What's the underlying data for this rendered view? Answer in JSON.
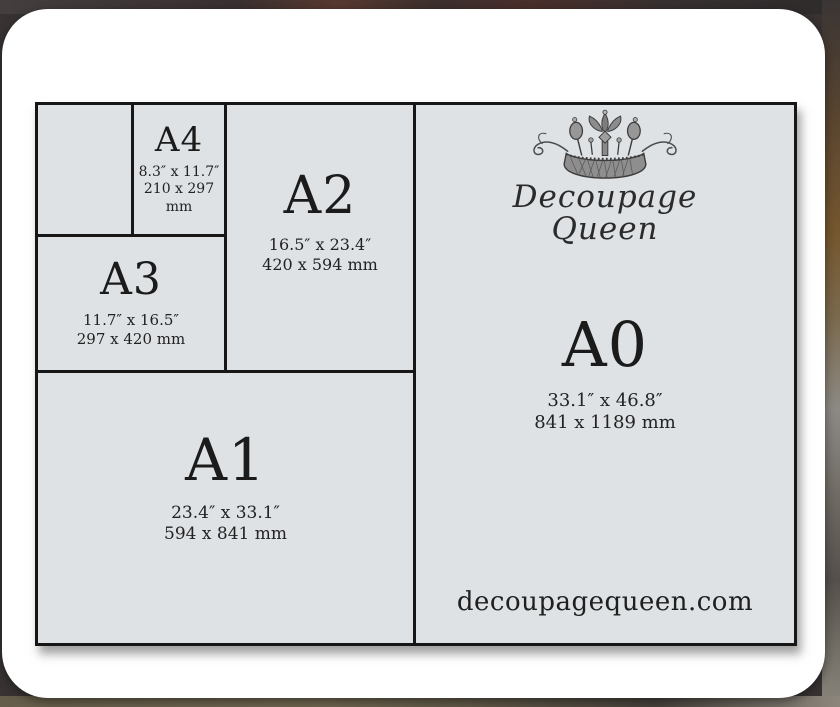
{
  "brand": {
    "name_line1": "Decoupage",
    "name_line2": "Queen",
    "website": "decoupagequeen.com"
  },
  "sizes": [
    {
      "label": "A4",
      "inches": "8.3″ x 11.7″",
      "mm": "210 x 297 mm"
    },
    {
      "label": "A3",
      "inches": "11.7″ x 16.5″",
      "mm": "297 x 420 mm"
    },
    {
      "label": "A2",
      "inches": "16.5″ x 23.4″",
      "mm": "420 x 594 mm"
    },
    {
      "label": "A1",
      "inches": "23.4″ x 33.1″",
      "mm": "594 x 841 mm"
    },
    {
      "label": "A0",
      "inches": "33.1″ x 46.8″",
      "mm": "841 x 1189 mm"
    }
  ],
  "colors": {
    "panel_background": "#dee2e5",
    "grid_line": "#171717",
    "text": "#1b1b1b",
    "card_background": "#ffffff"
  }
}
